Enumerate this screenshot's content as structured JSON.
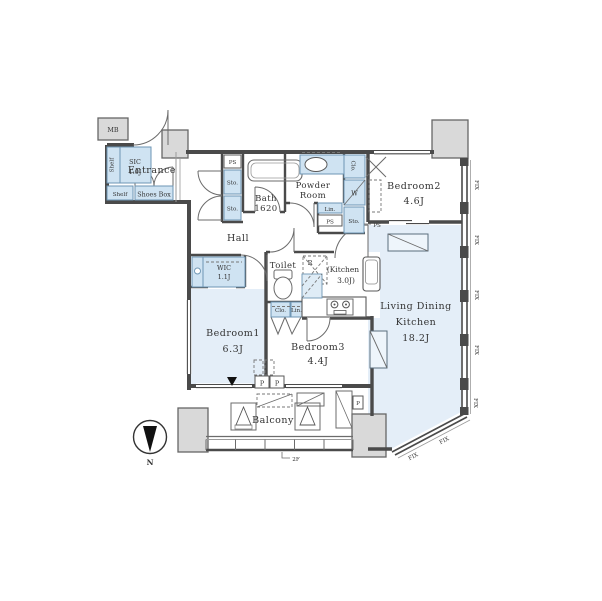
{
  "colors": {
    "wall": "#4a4a4a",
    "room_fill": "#e4eef8",
    "cabinet_fill": "#cfe3f2",
    "cabinet_border": "#6e96b4",
    "concrete_block": "#d9d9d9",
    "text": "#333333"
  },
  "rooms": {
    "entrance": {
      "label": "Entrance"
    },
    "hall": {
      "label": "Hall"
    },
    "bath": {
      "label": "Bath",
      "size": "1620"
    },
    "powder_room": {
      "line1": "Powder",
      "line2": "Room"
    },
    "toilet": {
      "label": "Toilet"
    },
    "kitchen": {
      "line1": "(Kitchen",
      "line2": "3.0J)"
    },
    "living": {
      "line1": "Living Dining",
      "line2": "Kitchen",
      "size": "18.2J"
    },
    "bedroom1": {
      "label": "Bedroom1",
      "size": "6.3J"
    },
    "bedroom2": {
      "label": "Bedroom2",
      "size": "4.6J"
    },
    "bedroom3": {
      "label": "Bedroom3",
      "size": "4.4J"
    },
    "wic": {
      "label": "WIC",
      "size": "1.1J"
    },
    "sic": {
      "label": "SIC",
      "size": "1.0J"
    },
    "balcony": {
      "label": "Balcony"
    }
  },
  "fixtures": {
    "meter_box": "MB",
    "shelf": "Shelf",
    "shoes_box": "Shoes Box",
    "pipe_space": "PS",
    "storage": "Sto.",
    "closet": "Clo.",
    "linen": "Lin.",
    "washer": "W",
    "refrigerator": "R",
    "pillar": "P",
    "fix_window": "FIX"
  },
  "annotations": {
    "north": "N",
    "floor": "2F"
  }
}
